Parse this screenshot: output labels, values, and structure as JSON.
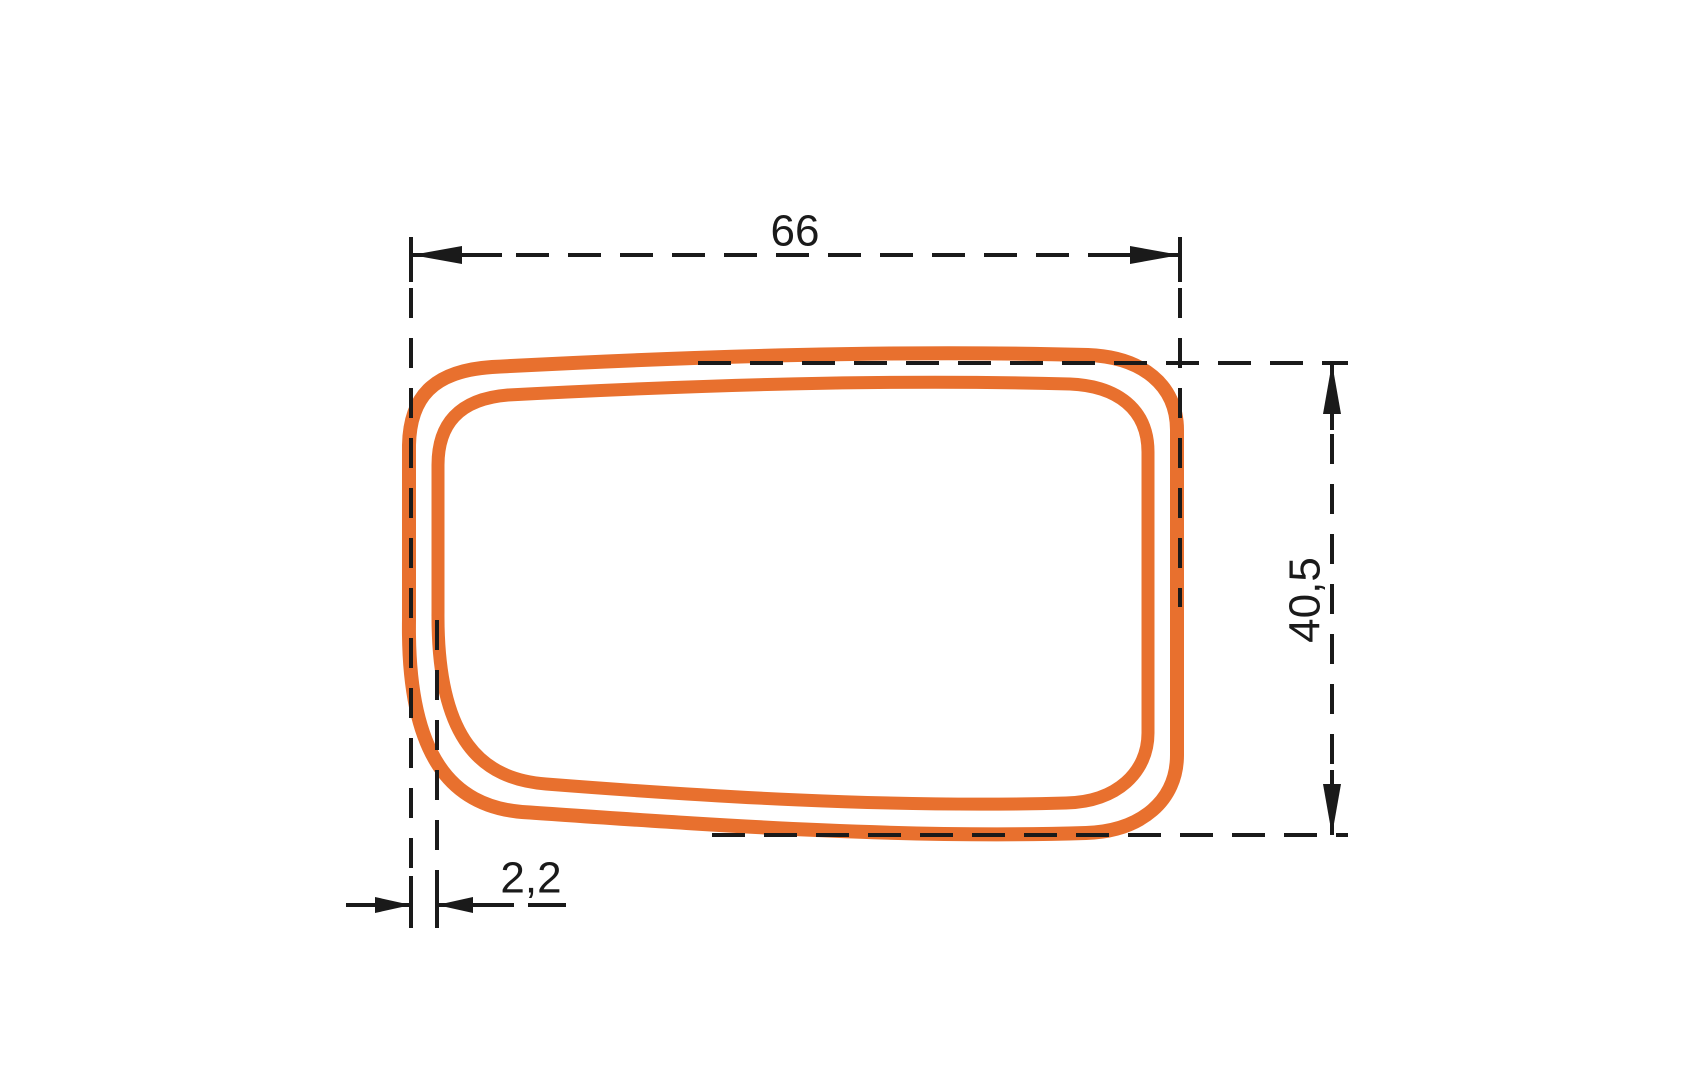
{
  "drawing": {
    "labels": {
      "width": "66",
      "height": "40,5",
      "wall_thickness": "2,2"
    },
    "colors": {
      "profile": "#E8702E",
      "line": "#1A1A1A",
      "background": "#FFFFFF"
    }
  }
}
